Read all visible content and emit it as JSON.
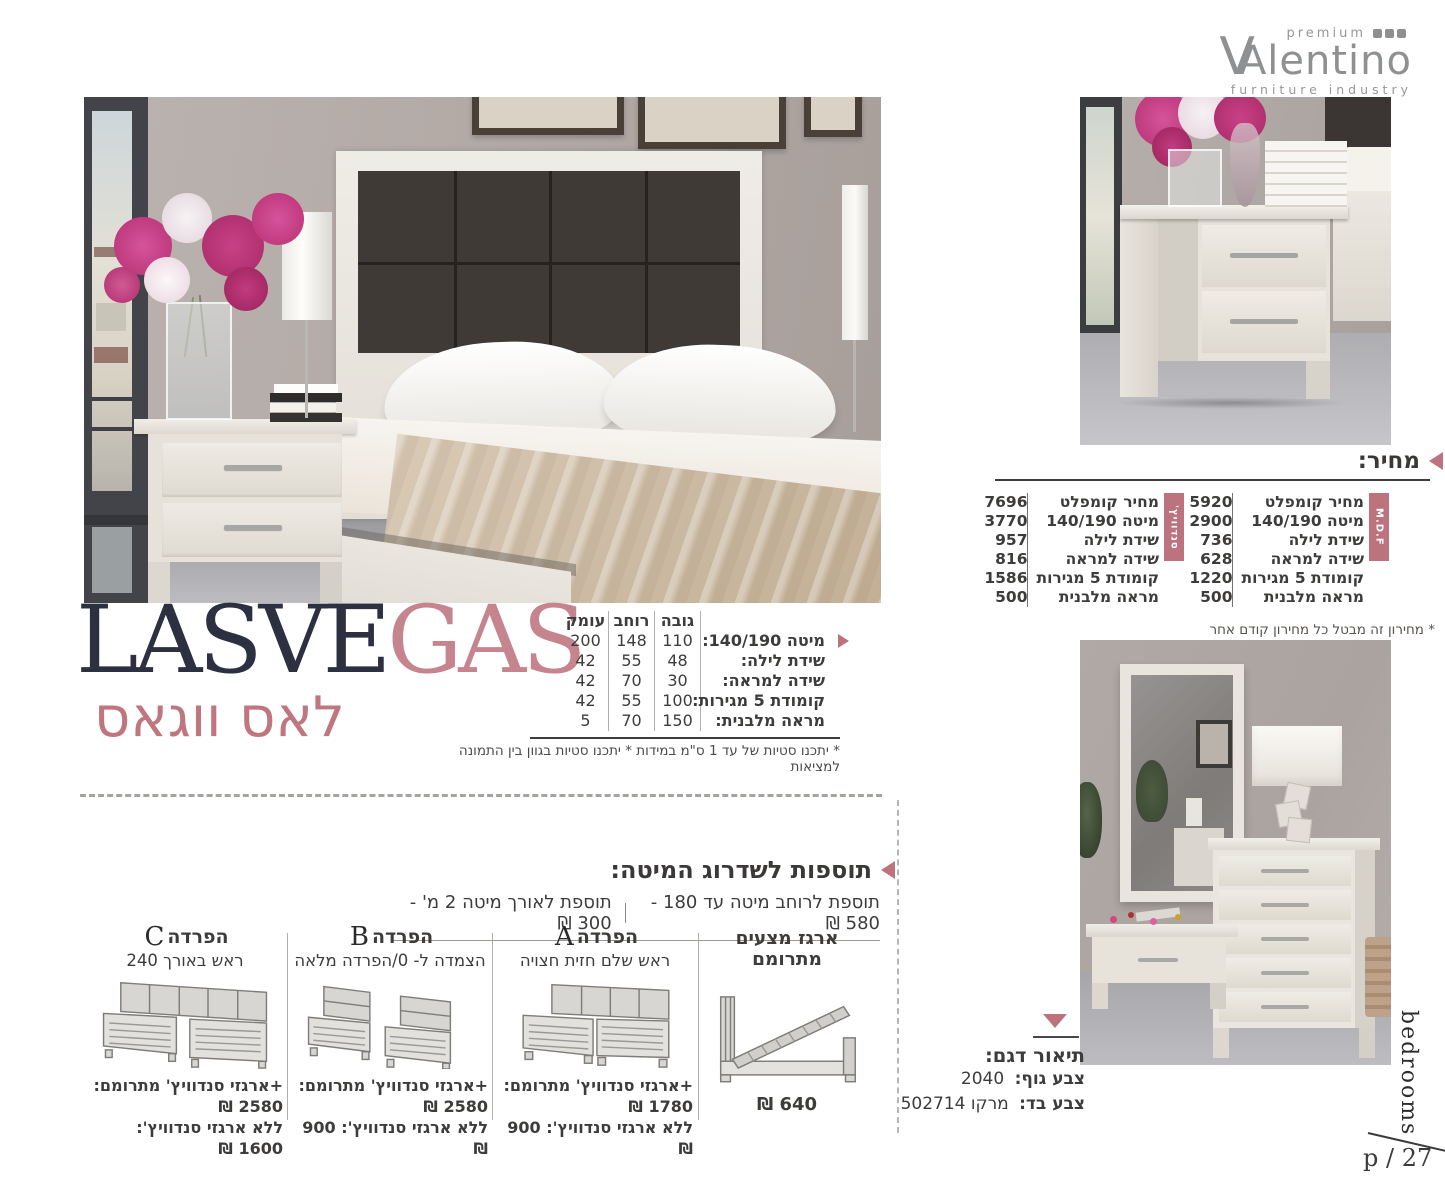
{
  "colors": {
    "accent": "#bd737e",
    "title_dark": "#2c3040"
  },
  "logo": {
    "premium": "premium",
    "brand_v": "V",
    "brand_rest": "Alentino",
    "tagline": "furniture industry"
  },
  "price_section": {
    "title": "מחיר:",
    "mdf": {
      "tab": "M.D.F",
      "rows": [
        {
          "label": "מחיר קומפלט",
          "value": "5920"
        },
        {
          "label": "מיטה 140/190",
          "value": "2900"
        },
        {
          "label": "שידת לילה",
          "value": "736"
        },
        {
          "label": "שידה למראה",
          "value": "628"
        },
        {
          "label": "קומודת 5 מגירות",
          "value": "1220"
        },
        {
          "label": "מראה מלבנית",
          "value": "500"
        }
      ]
    },
    "sandwich": {
      "tab": "סנדוויץ'",
      "rows": [
        {
          "label": "מחיר קומפלט",
          "value": "7696"
        },
        {
          "label": "מיטה 140/190",
          "value": "3770"
        },
        {
          "label": "שידת לילה",
          "value": "957"
        },
        {
          "label": "שידה למראה",
          "value": "816"
        },
        {
          "label": "קומודת 5 מגירות",
          "value": "1586"
        },
        {
          "label": "מראה מלבנית",
          "value": "500"
        }
      ]
    },
    "footnote": "* מחירון זה מבטל כל מחירון קודם אחר"
  },
  "title_block": {
    "latin_dark": "LASVE",
    "latin_accent": "GAS",
    "hebrew": "לאס ווגאס"
  },
  "dimensions": {
    "headers": {
      "height": "גובה",
      "width": "רוחב",
      "depth": "עומק"
    },
    "rows": [
      {
        "label": "מיטה 140/190:",
        "height": "110",
        "width": "148",
        "depth": "200"
      },
      {
        "label": "שידת לילה:",
        "height": "48",
        "width": "55",
        "depth": "42"
      },
      {
        "label": "שידה למראה:",
        "height": "30",
        "width": "70",
        "depth": "42"
      },
      {
        "label": "קומודת 5 מגירות:",
        "height": "100",
        "width": "55",
        "depth": "42"
      },
      {
        "label": "מראה מלבנית:",
        "height": "150",
        "width": "70",
        "depth": "5"
      }
    ],
    "footnote": "* יתכנו סטיות של עד 1 ס\"מ במידות * יתכנו סטיות בגוון בין התמונה למציאות"
  },
  "upgrades": {
    "title": "תוספות לשדרוג המיטה:",
    "width_addon": "תוספת לרוחב מיטה עד 180 - 580 ₪",
    "length_addon": "תוספת לאורך מיטה 2 מ' - 300 ₪",
    "storage_box": {
      "title": "ארגז מצעים מתרומם",
      "price": "640 ₪"
    },
    "separations": [
      {
        "name": "הפרדה",
        "letter": "A",
        "subtitle": "ראש שלם חזית חצויה",
        "with_box": "+ארגזי סנדוויץ' מתרומם: 1780 ₪",
        "without_box": "ללא ארגזי סנדוויץ': 900 ₪"
      },
      {
        "name": "הפרדה",
        "letter": "B",
        "subtitle": "הצמדה ל- 0/הפרדה מלאה",
        "with_box": "+ארגזי סנדוויץ' מתרומם: 2580 ₪",
        "without_box": "ללא ארגזי סנדוויץ': 900 ₪"
      },
      {
        "name": "הפרדה",
        "letter": "C",
        "subtitle": "ראש באורך 240",
        "with_box": "+ארגזי סנדוויץ' מתרומם: 2580 ₪",
        "without_box": "ללא ארגזי סנדוויץ': 1600 ₪"
      }
    ]
  },
  "model_description": {
    "title": "תיאור דגם:",
    "body_color_label": "צבע גוף:",
    "body_color_value": "2040",
    "fabric_color_label": "צבע בד:",
    "fabric_color_value": "מרקו 502714"
  },
  "footer": {
    "section_label": "bedrooms",
    "page_number": "p / 27"
  }
}
